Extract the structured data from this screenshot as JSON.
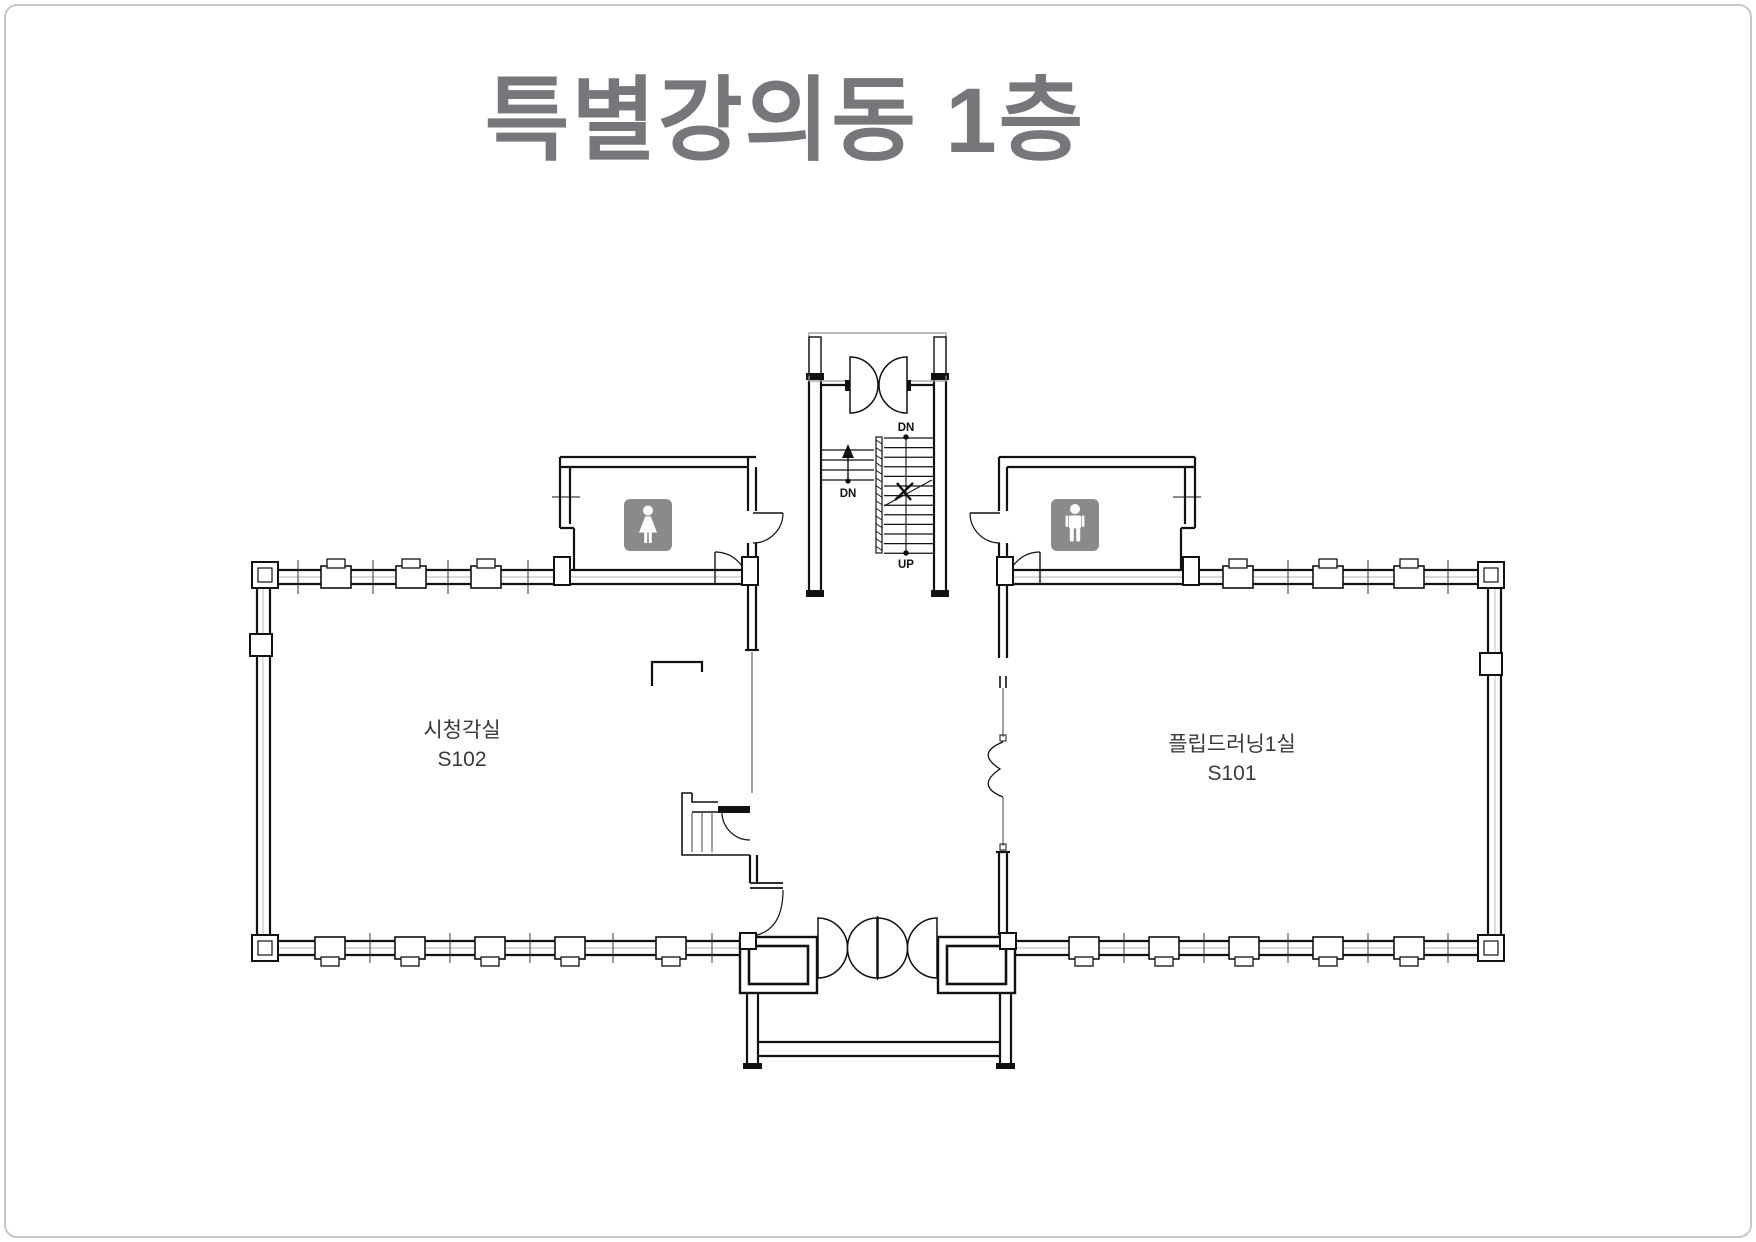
{
  "page": {
    "title": "특별강의동 1층"
  },
  "rooms": [
    {
      "name": "시청각실",
      "code": "S102"
    },
    {
      "name": "플립드러닝1실",
      "code": "S101"
    }
  ],
  "stairs": {
    "main_top": "DN",
    "main_bottom": "UP",
    "side": "DN"
  },
  "icons": {
    "women_restroom": "woman-figure-icon",
    "men_restroom": "man-figure-icon"
  },
  "colors": {
    "wall": "#111111",
    "title": "#76777a",
    "label": "#3a3a3a",
    "icon_bg": "#8a8a8a",
    "light_line": "#9a9a9a",
    "page_border": "#c8c8c8"
  }
}
